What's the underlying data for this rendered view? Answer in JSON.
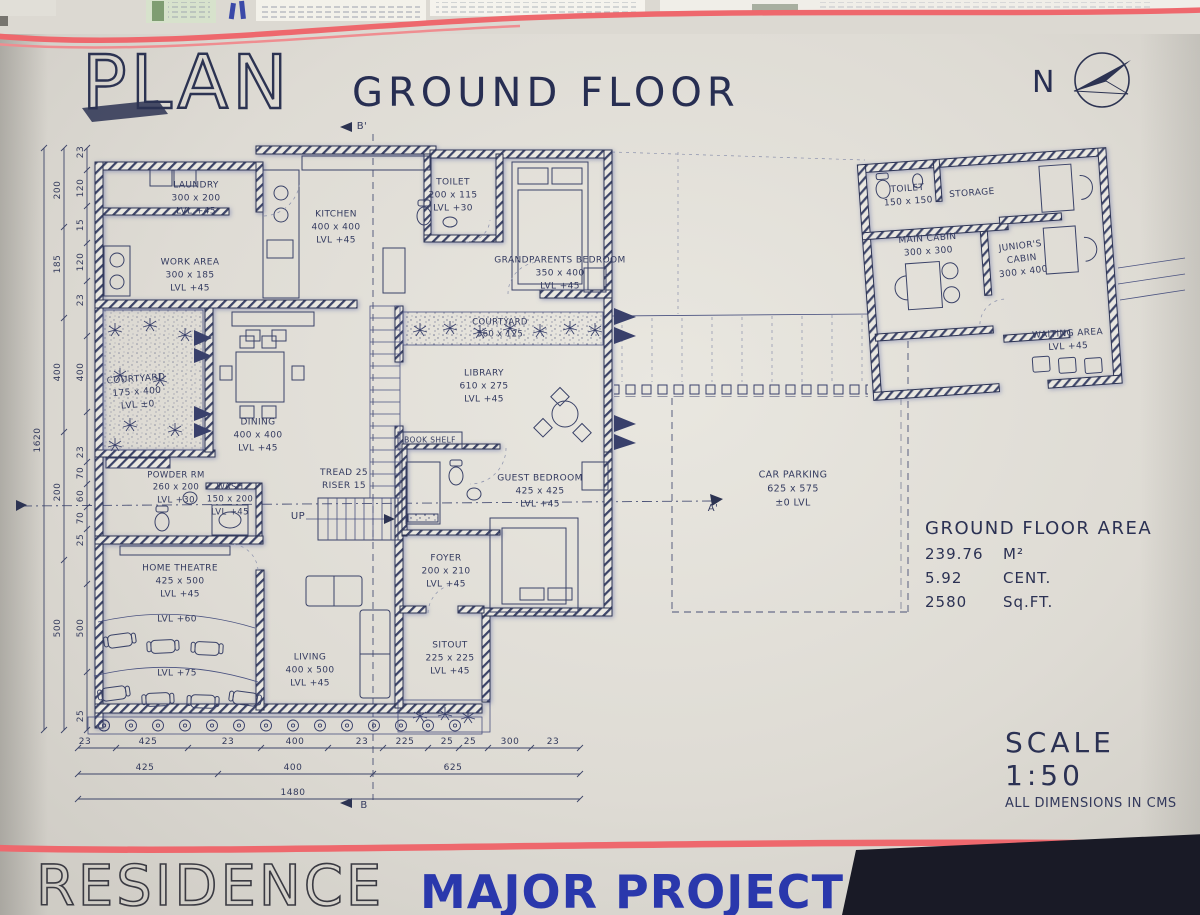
{
  "sheet": {
    "plan_title": "PLAN",
    "floor_title": "GROUND FLOOR",
    "scale": "SCALE 1:50",
    "dim_note": "ALL DIMENSIONS IN CMS"
  },
  "north": {
    "label": "N"
  },
  "footer": {
    "residence": "RESIDENCE",
    "project": "MAJOR PROJECT"
  },
  "area": {
    "title": "GROUND FLOOR AREA",
    "rows": [
      [
        "239.76",
        "M²"
      ],
      [
        "5.92",
        "CENT."
      ],
      [
        "2580",
        "Sq.FT."
      ]
    ]
  },
  "plan_labels": [
    {
      "id": "laundry",
      "lines": [
        "LAUNDRY",
        "300 x 200",
        "LVL +45"
      ],
      "x": 196,
      "y": 199
    },
    {
      "id": "kitchen",
      "lines": [
        "KITCHEN",
        "400 x 400",
        "LVL +45"
      ],
      "x": 336,
      "y": 228
    },
    {
      "id": "toilet-house",
      "lines": [
        "TOILET",
        "200 x 115",
        "LVL +30"
      ],
      "x": 453,
      "y": 196
    },
    {
      "id": "grandparents-bedroom",
      "lines": [
        "GRANDPARENTS BEDROOM",
        "350 x 400",
        "LVL +45"
      ],
      "x": 560,
      "y": 274
    },
    {
      "id": "work-area",
      "lines": [
        "WORK AREA",
        "300 x 185",
        "LVL +45"
      ],
      "x": 190,
      "y": 276
    },
    {
      "id": "courtyard-center",
      "lines": [
        "COURTYARD",
        "560 x 125"
      ],
      "x": 500,
      "y": 329,
      "fs": 8.5
    },
    {
      "id": "library",
      "lines": [
        "LIBRARY",
        "610 x 275",
        "LVL +45"
      ],
      "x": 484,
      "y": 387
    },
    {
      "id": "courtyard-left",
      "lines": [
        "COURTYARD",
        "175 x 400",
        "LVL ±0"
      ],
      "x": 137,
      "y": 393,
      "rot": -4
    },
    {
      "id": "dining",
      "lines": [
        "DINING",
        "400 x 400",
        "LVL +45"
      ],
      "x": 258,
      "y": 436
    },
    {
      "id": "book-shelf",
      "lines": [
        "BOOK SHELF"
      ],
      "x": 430,
      "y": 441,
      "fs": 7.5
    },
    {
      "id": "stair-note",
      "lines": [
        "TREAD 25",
        "RISER 15"
      ],
      "x": 344,
      "y": 480
    },
    {
      "id": "powder-rm",
      "lines": [
        "POWDER RM",
        "260 x 200",
        "LVL +30"
      ],
      "x": 176,
      "y": 488,
      "fs": 8.5
    },
    {
      "id": "wash",
      "lines": [
        "WASH",
        "150 x 200",
        "LVL +45"
      ],
      "x": 230,
      "y": 500,
      "fs": 8.5
    },
    {
      "id": "up",
      "lines": [
        "UP"
      ],
      "x": 298,
      "y": 517,
      "fs": 10
    },
    {
      "id": "guest-bedroom",
      "lines": [
        "GUEST BEDROOM",
        "425 x 425",
        "LVL +45"
      ],
      "x": 540,
      "y": 492
    },
    {
      "id": "foyer",
      "lines": [
        "FOYER",
        "200 x 210",
        "LVL +45"
      ],
      "x": 446,
      "y": 572
    },
    {
      "id": "home-theatre",
      "lines": [
        "HOME THEATRE",
        "425 x 500",
        "LVL +45"
      ],
      "x": 180,
      "y": 582
    },
    {
      "id": "theatre-lvl-60",
      "lines": [
        "LVL +60"
      ],
      "x": 177,
      "y": 620
    },
    {
      "id": "theatre-lvl-75",
      "lines": [
        "LVL +75"
      ],
      "x": 177,
      "y": 674
    },
    {
      "id": "living",
      "lines": [
        "LIVING",
        "400 x 500",
        "LVL +45"
      ],
      "x": 310,
      "y": 671
    },
    {
      "id": "sitout",
      "lines": [
        "SITOUT",
        "225 x 225",
        "LVL +45"
      ],
      "x": 450,
      "y": 659
    },
    {
      "id": "car-parking",
      "lines": [
        "CAR PARKING",
        "625 x 575",
        "±0 LVL"
      ],
      "x": 793,
      "y": 489,
      "fs": 9.5
    },
    {
      "id": "toilet-office",
      "lines": [
        "TOILET",
        "150 x 150"
      ],
      "x": 908,
      "y": 196,
      "rot": -4
    },
    {
      "id": "storage",
      "lines": [
        "STORAGE"
      ],
      "x": 972,
      "y": 194,
      "rot": -4
    },
    {
      "id": "main-cabin",
      "lines": [
        "MAIN CABIN",
        "300 x 300"
      ],
      "x": 928,
      "y": 246,
      "rot": -4
    },
    {
      "id": "junior-cabin",
      "lines": [
        "JUNIOR'S",
        "CABIN",
        "300 x 400"
      ],
      "x": 1022,
      "y": 260,
      "rot": -7
    },
    {
      "id": "waiting-area",
      "lines": [
        "WAITING AREA",
        "LVL +45"
      ],
      "x": 1068,
      "y": 341,
      "rot": -3
    },
    {
      "id": "section-b-top",
      "lines": [
        "B'"
      ],
      "x": 362,
      "y": 127,
      "fs": 10
    },
    {
      "id": "section-b-bottom",
      "lines": [
        "B"
      ],
      "x": 364,
      "y": 806,
      "fs": 10
    },
    {
      "id": "section-a-right",
      "lines": [
        "A'"
      ],
      "x": 713,
      "y": 509,
      "fs": 10
    }
  ],
  "dims": {
    "horizontal": [
      {
        "y": 748,
        "x1": 78,
        "x2": 580,
        "ticks": [
          78,
          116,
          188,
          261,
          328,
          383,
          428,
          459,
          488,
          531,
          580
        ],
        "labels": [
          {
            "t": "23",
            "x": 85
          },
          {
            "t": "425",
            "x": 148
          },
          {
            "t": "23",
            "x": 228
          },
          {
            "t": "400",
            "x": 295
          },
          {
            "t": "23",
            "x": 362
          },
          {
            "t": "225",
            "x": 405
          },
          {
            "t": "25",
            "x": 447
          },
          {
            "t": "25",
            "x": 470
          },
          {
            "t": "300",
            "x": 510
          },
          {
            "t": "23",
            "x": 553
          }
        ]
      },
      {
        "y": 774,
        "x1": 78,
        "x2": 580,
        "ticks": [
          78,
          218,
          373,
          580
        ],
        "labels": [
          {
            "t": "425",
            "x": 145
          },
          {
            "t": "400",
            "x": 293
          },
          {
            "t": "625",
            "x": 453
          }
        ]
      },
      {
        "y": 799,
        "x1": 78,
        "x2": 580,
        "ticks": [
          78,
          580
        ],
        "labels": [
          {
            "t": "1480",
            "x": 293
          }
        ]
      }
    ],
    "vertical": [
      {
        "x": 87,
        "y1": 148,
        "y2": 730,
        "ticks": [
          148,
          170,
          206,
          243,
          281,
          336,
          412,
          462,
          484,
          507,
          529,
          584,
          672,
          730
        ],
        "labels": [
          {
            "t": "23",
            "y": 152
          },
          {
            "t": "120",
            "y": 188
          },
          {
            "t": "15",
            "y": 225
          },
          {
            "t": "120",
            "y": 262
          },
          {
            "t": "23",
            "y": 300
          },
          {
            "t": "400",
            "y": 372
          },
          {
            "t": "23",
            "y": 452
          },
          {
            "t": "70",
            "y": 473
          },
          {
            "t": "60",
            "y": 496
          },
          {
            "t": "70",
            "y": 518
          },
          {
            "t": "25",
            "y": 540
          },
          {
            "t": "500",
            "y": 628
          },
          {
            "t": "25",
            "y": 716
          }
        ]
      },
      {
        "x": 64,
        "y1": 148,
        "y2": 730,
        "ticks": [
          148,
          227,
          318,
          432,
          560,
          730
        ],
        "labels": [
          {
            "t": "200",
            "y": 190
          },
          {
            "t": "185",
            "y": 264
          },
          {
            "t": "400",
            "y": 372
          },
          {
            "t": "200",
            "y": 492
          },
          {
            "t": "500",
            "y": 628
          }
        ]
      },
      {
        "x": 44,
        "y1": 148,
        "y2": 730,
        "ticks": [
          148,
          730
        ],
        "labels": [
          {
            "t": "1620",
            "y": 440
          }
        ]
      }
    ]
  }
}
